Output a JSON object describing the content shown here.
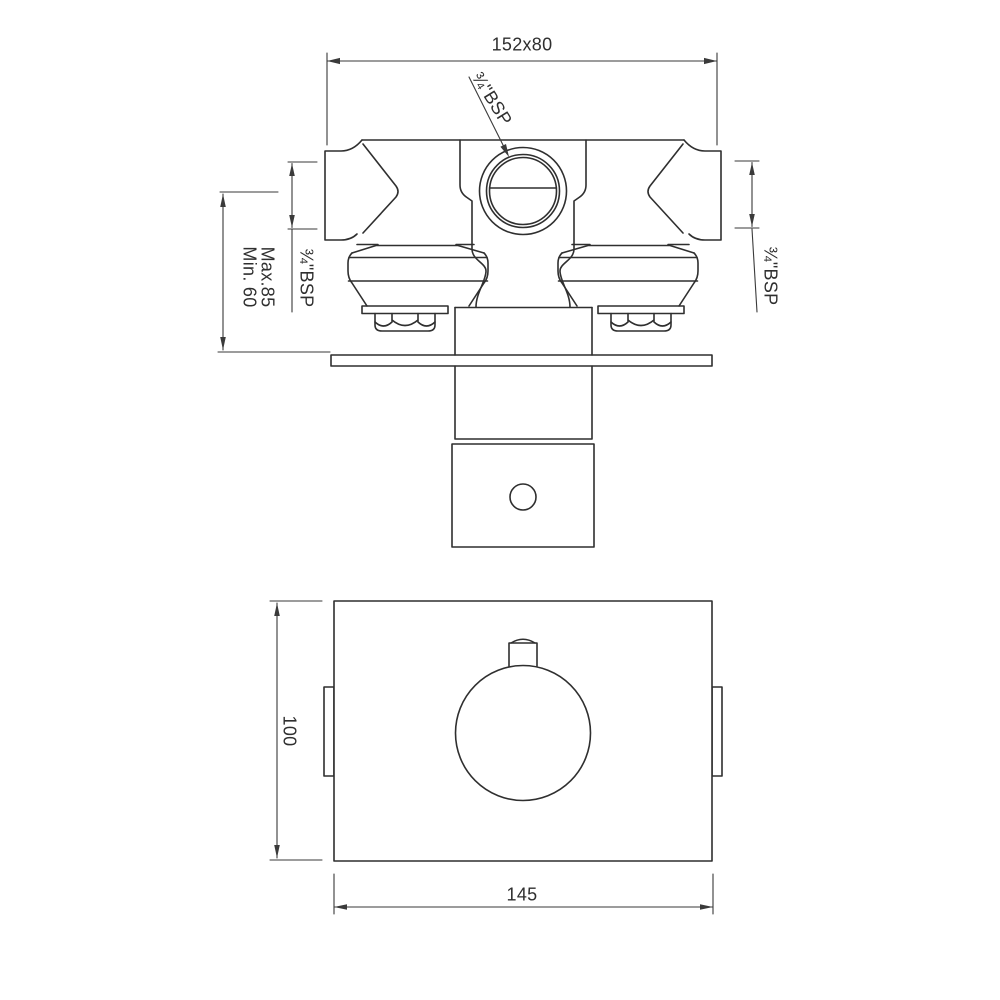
{
  "colors": {
    "ink": "#2f2f2f",
    "dim": "#3a3a3a",
    "background": "#ffffff"
  },
  "drawing": {
    "type": "technical-dimension-drawing",
    "views": {
      "top_view": {
        "name": "valve body – top view",
        "dimensions": {
          "width_label": "152x80",
          "outlet_label": "¾\"BSP",
          "left_inlet_label": "¾\"BSP",
          "right_inlet_label": "¾\"BSP",
          "depth_min_label": "Min. 60",
          "depth_max_label": "Max.85"
        }
      },
      "front_view": {
        "name": "wall plate – front view",
        "dimensions": {
          "height_label": "100",
          "width_label": "145"
        }
      }
    }
  }
}
